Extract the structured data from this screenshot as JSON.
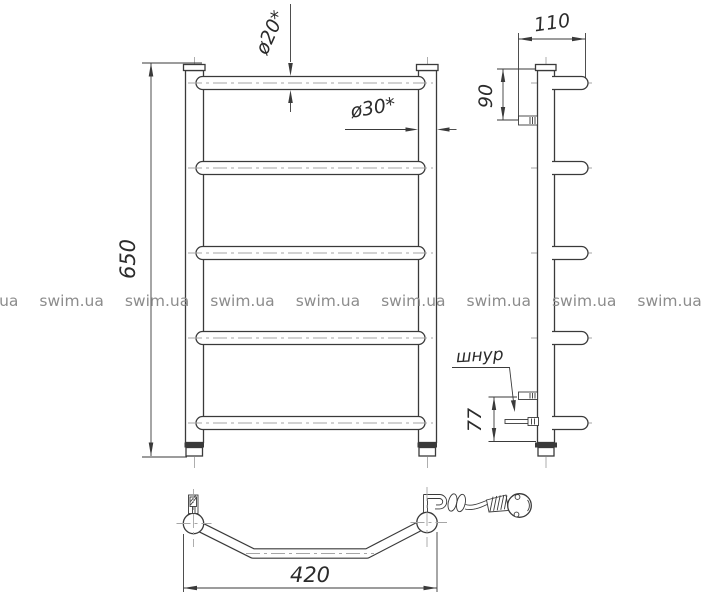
{
  "page": {
    "background": "#ffffff",
    "line_color": "#3a3a3a",
    "centerline_color": "#a6a6a6",
    "text_color": "#2b2b2b"
  },
  "watermark": {
    "text": "swim.ua",
    "color": "#8c8c8c",
    "count": 11
  },
  "dimensions": {
    "height": "650",
    "width": "420",
    "depth": "110",
    "top_bracket_offset": "90",
    "cord_offset": "77",
    "rung_diameter": "ø20*",
    "post_diameter": "ø30*",
    "cord_label": "шнур"
  }
}
